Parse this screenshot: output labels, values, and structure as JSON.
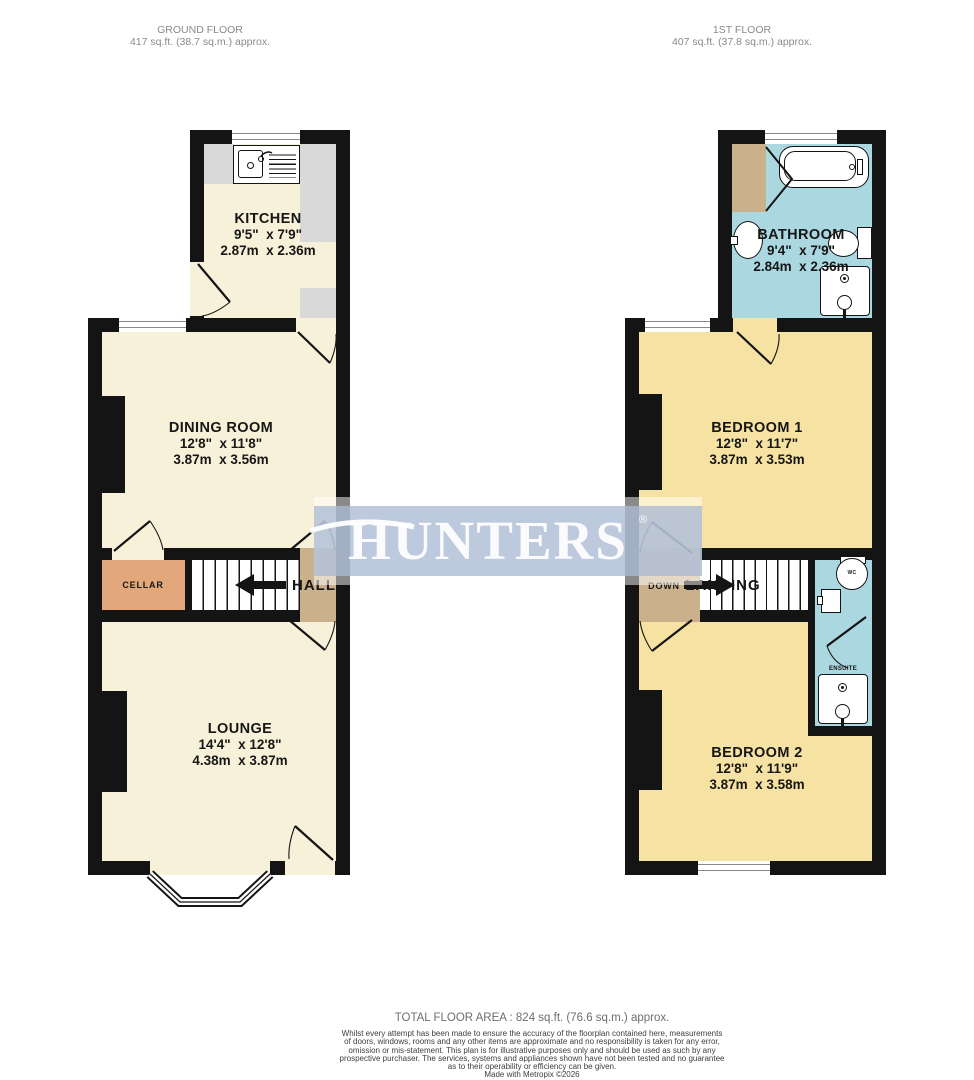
{
  "floors": {
    "ground": {
      "title": "GROUND FLOOR",
      "area": "417 sq.ft. (38.7 sq.m.) approx.",
      "rooms": {
        "kitchen": {
          "name": "KITCHEN",
          "dims_ft": "9'5\"  x 7'9\"",
          "dims_m": "2.87m  x 2.36m"
        },
        "dining": {
          "name": "DINING ROOM",
          "dims_ft": "12'8\"  x 11'8\"",
          "dims_m": "3.87m  x 3.56m"
        },
        "lounge": {
          "name": "LOUNGE",
          "dims_ft": "14'4\"  x 12'8\"",
          "dims_m": "4.38m  x 3.87m"
        },
        "cellar": {
          "name": "CELLAR"
        },
        "hall": {
          "name": "HALL"
        }
      }
    },
    "first": {
      "title": "1ST FLOOR",
      "area": "407 sq.ft. (37.8 sq.m.) approx.",
      "rooms": {
        "bathroom": {
          "name": "BATHROOM",
          "dims_ft": "9'4\"  x 7'9\"",
          "dims_m": "2.84m  x 2.36m"
        },
        "bedroom1": {
          "name": "BEDROOM 1",
          "dims_ft": "12'8\"  x 11'7\"",
          "dims_m": "3.87m  x 3.53m"
        },
        "bedroom2": {
          "name": "BEDROOM 2",
          "dims_ft": "12'8\"  x 11'9\"",
          "dims_m": "3.87m  x 3.58m"
        },
        "landing": {
          "name": "LANDING",
          "down_label": "DOWN"
        },
        "ensuite": {
          "name": "ENSUITE"
        },
        "wc": {
          "name": "WC"
        }
      }
    }
  },
  "watermark": {
    "brand": "HUNTERS",
    "registered": "®"
  },
  "footer": {
    "total": "TOTAL FLOOR AREA : 824 sq.ft. (76.6 sq.m.) approx.",
    "disclaimer_lines": [
      "Whilst every attempt has been made to ensure the accuracy of the floorplan contained here, measurements",
      "of doors, windows, rooms and any other items are approximate and no responsibility is taken for any error,",
      "omission or mis-statement. This plan is for illustrative purposes only and should be used as such by any",
      "prospective purchaser. The services, systems and appliances shown have not been tested and no guarantee",
      "as to their operability or efficiency can be given."
    ],
    "credit": "Made with Metropix ©2026"
  },
  "colors": {
    "wall": "#141414",
    "ground_floor": "#f8f1d9",
    "bedroom_floor": "#f6e2a2",
    "bathroom_floor": "#abd7e1",
    "hallway": "#cbb08c",
    "cellar": "#e2a87c",
    "counter": "#d9d9d9",
    "watermark_band": "#bfcbdd"
  }
}
